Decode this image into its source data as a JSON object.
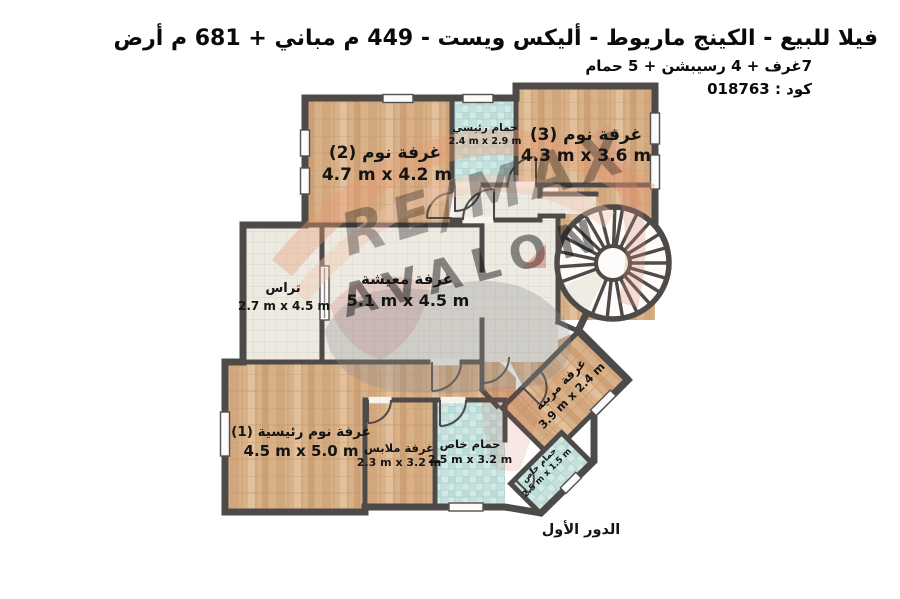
{
  "header": {
    "title": "فيلا للبيع - الكينج ماريوط - أليكس ويست - 449 م مباني + 681 م أرض",
    "subtitle": "7غرف + 4 رسيبشن + 5 حمام",
    "code_label": "كود : 018763"
  },
  "floor_label": "الدور الأول",
  "watermark": {
    "brand": "RE/MAX",
    "name": "AVALON"
  },
  "rooms": [
    {
      "key": "bedroom-2",
      "name": "غرفة نوم (2)",
      "dims": "4.7 m x 4.2 m"
    },
    {
      "key": "main-bathroom",
      "name": "حمام رئيسي",
      "dims": "2.4 m x 2.9 m"
    },
    {
      "key": "bedroom-3",
      "name": "غرفة نوم (3)",
      "dims": "4.3 m x 3.6 m"
    },
    {
      "key": "terrace",
      "name": "تراس",
      "dims": "2.7 m x 4.5 m"
    },
    {
      "key": "living-room",
      "name": "غرفة معيشة",
      "dims": "5.1 m x 4.5 m"
    },
    {
      "key": "master-bedroom-1",
      "name": "غرفة نوم رئيسية (1)",
      "dims": "4.5 m x 5.0 m"
    },
    {
      "key": "dressing-room",
      "name": "غرفة ملابس",
      "dims": "2.3 m x 3.2 m"
    },
    {
      "key": "private-bathroom",
      "name": "حمام خاص",
      "dims": "2.5 m x 3.2 m"
    },
    {
      "key": "nanny-room",
      "name": "غرفة مربية",
      "dims": "3.9 m x 2.4 m"
    },
    {
      "key": "small-private-bathroom",
      "name": "حمام خاص",
      "dims": "2.5 m x 1.5 m"
    }
  ],
  "colors": {
    "wall": "#4e4a48",
    "wood_floor": "#d9b189",
    "tile_floor": "#edeae2",
    "bath_floor": "#d3e9e6",
    "watermark_red": "#b23c34",
    "watermark_gray": "#8f8a84"
  }
}
